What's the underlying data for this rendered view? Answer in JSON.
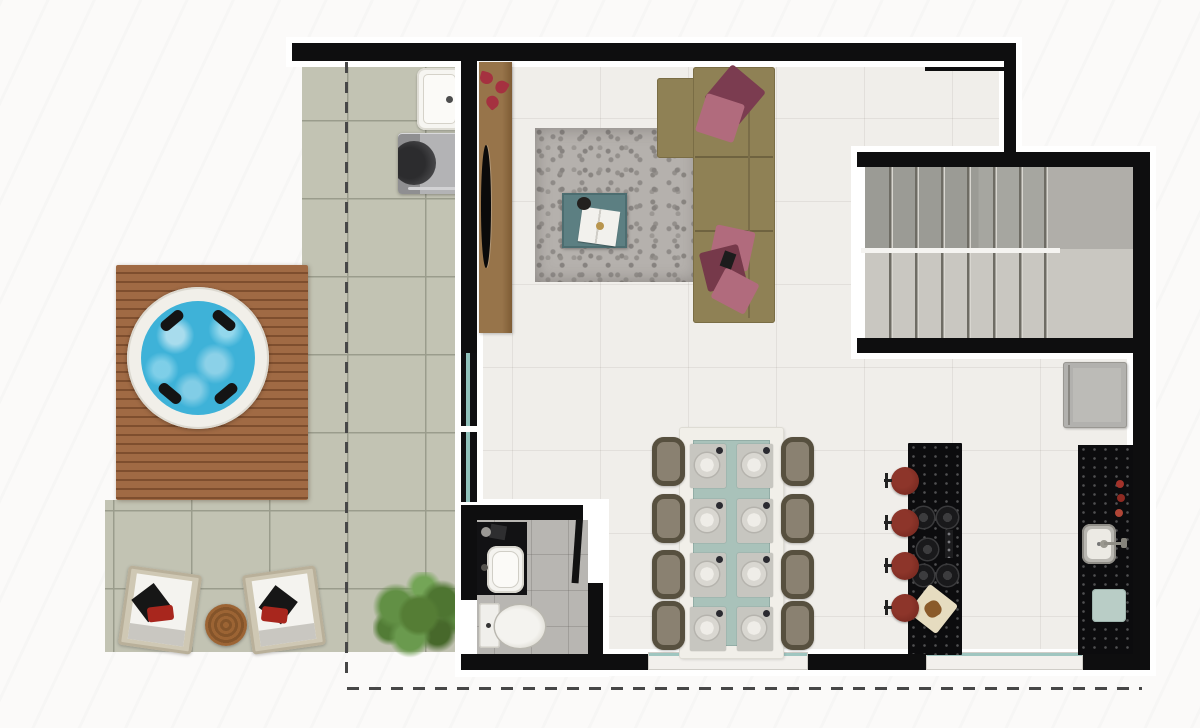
{
  "meta": {
    "kind": "architectural floor plan (top-down rendered view)",
    "visible_text": "none"
  },
  "rooms": [
    {
      "name": "terrace"
    },
    {
      "name": "living-room"
    },
    {
      "name": "dining-area"
    },
    {
      "name": "kitchen"
    },
    {
      "name": "bathroom"
    },
    {
      "name": "staircase"
    },
    {
      "name": "hall"
    }
  ],
  "furniture": {
    "terrace": [
      "wood-deck",
      "hot-tub",
      "lounge-chairs",
      "round-side-table",
      "outdoor-sink",
      "grill",
      "plant"
    ],
    "living_room": [
      "tv-console",
      "tv",
      "rug",
      "coffee-table",
      "books",
      "sectional-sofa",
      "pillows",
      "flowers"
    ],
    "dining_area": [
      "dining-table",
      "dining-chairs",
      "place-settings"
    ],
    "kitchen": [
      "island-with-cooktop",
      "bar-stools",
      "cutting-board",
      "counter-with-sink",
      "faucet",
      "bottles",
      "tray",
      "fridge"
    ],
    "bathroom": [
      "vanity",
      "basin-sink",
      "toilet",
      "door"
    ]
  },
  "counts": {
    "lounge_chairs": 2,
    "hot_tub_headrests": 4,
    "dining_chairs": 8,
    "place_settings": 8,
    "bar_stools": 4,
    "cooktop_burners": 5,
    "stair_flights": 2,
    "stair_treads_per_flight": 8,
    "stair_tread_lines_per_flight": 7,
    "bottles": 3
  },
  "palette": {
    "wall": "#0e0e0f",
    "trim": "#ffffff",
    "terrace_tile": "#c2c3b3",
    "deck_wood": "#9d6a42",
    "hot_tub_water": "#3eb2d8",
    "interior_floor": "#f0eeea",
    "rug": "#b5b1ad",
    "sofa": "#8f8155",
    "pillow_dark": "#7b3c50",
    "pillow_light": "#b16b7d",
    "console_wood": "#8c6a40",
    "coffee_table": "#5c7f82",
    "stair_upper": "#9b9b95",
    "stair_lower": "#c9c7c1",
    "dining_runner": "#a9c2b9",
    "dining_chair": "#57503f",
    "granite": "#0c0c0e",
    "stool": "#7c2a20",
    "fridge": "#b2b1ae",
    "bathroom_floor": "#b8b6b2",
    "plant": "#567c36",
    "accent_red": "#a8261d",
    "glass": "#9fc6c0",
    "dashed_line": "#474747"
  }
}
